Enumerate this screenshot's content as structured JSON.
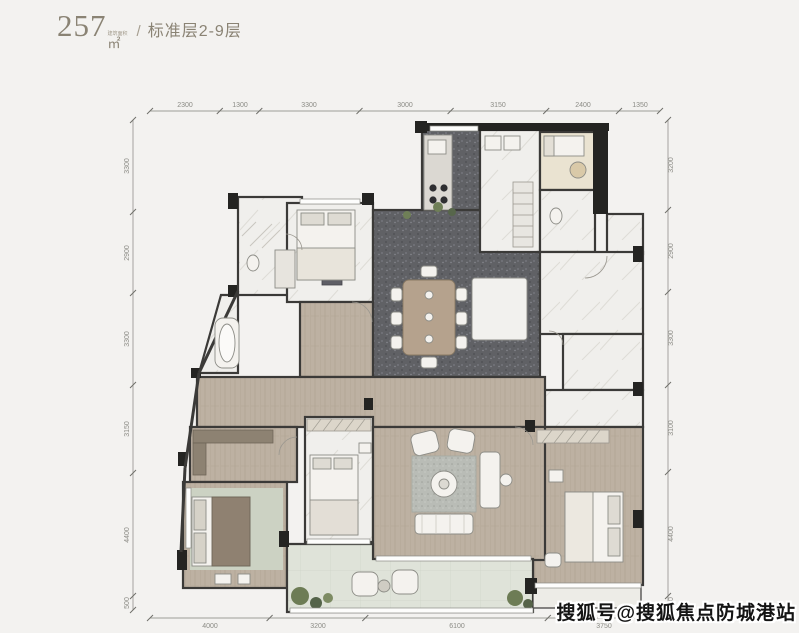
{
  "header": {
    "area_value": "257",
    "area_unit_prefix": "建筑面积",
    "area_unit": "㎡",
    "separator": "/",
    "floor_range_label": "标准层2-9层"
  },
  "dimensions": {
    "top": [
      "2300",
      "1300",
      "3300",
      "3000",
      "3150",
      "2400",
      "1350"
    ],
    "bottom": [
      "4000",
      "3200",
      "6100",
      "3750"
    ],
    "left": [
      "3300",
      "2900",
      "3300",
      "3150",
      "4400",
      "500"
    ],
    "right": [
      "3200",
      "2900",
      "3300",
      "3100",
      "4400",
      "500"
    ]
  },
  "watermark": {
    "text": "搜狐号@搜狐焦点防城港站"
  },
  "colors": {
    "background": "#f3f2f0",
    "wall": "#3b3a38",
    "wood_floor": "#bdb1a2",
    "dark_tile": "#606165",
    "marble": "#f0efec",
    "balcony": "#dfe3d9",
    "master_rug": "#ccd2c3",
    "plant": "#6d7c55",
    "title_text": "#8a8374",
    "dimension_text": "#8b8b85"
  }
}
